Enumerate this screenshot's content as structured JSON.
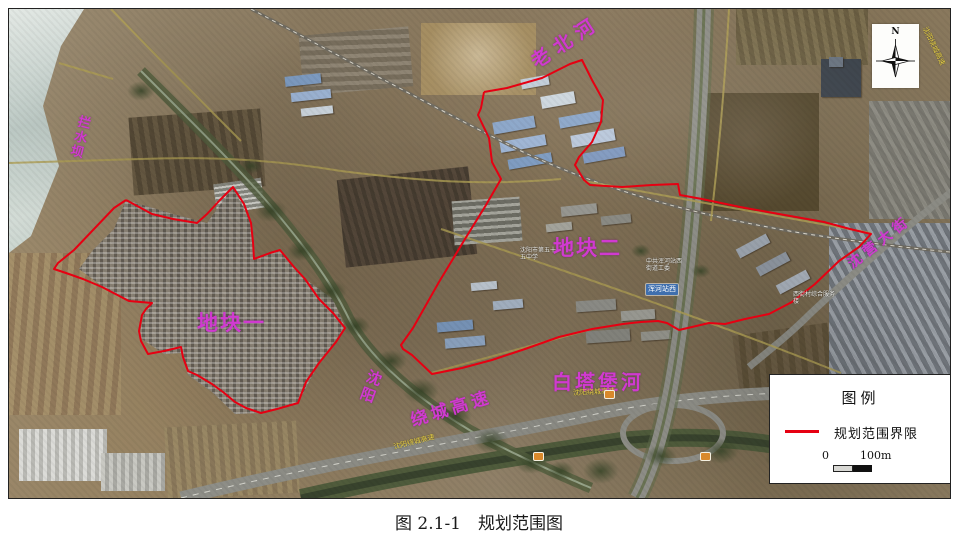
{
  "caption": "图 2.1-1　规划范围图",
  "map": {
    "plot_labels": {
      "plot1": "地块一",
      "plot2": "地块二"
    },
    "water_labels": {
      "dam": "拦水坝",
      "laobei_river": "老北河",
      "baitabao_river": "白塔堡河"
    },
    "road_labels": {
      "ring_expressway_part1": "沈阳",
      "ring_expressway_part2": "绕城高速",
      "shenying_street": "沈营大街"
    },
    "imagery_labels": {
      "ring_road_yellow_mid": "沈阳绕城高速",
      "ring_road_yellow_left": "沈阳绕城高速",
      "ring_road_yellow_top": "沈阳绕城高速",
      "hunhe_station_sign": "浑河站西",
      "school": "沈阳市第五十五中学",
      "committee": "中共浑河站西街道工委",
      "service_center": "西街村综合服务楼"
    },
    "boundary": {
      "color": "#e60012",
      "plot1_points": "125,199 151,213 172,218 196,222 206,213 219,199 232,186 243,203 250,222 252,241 253,258 269,252 279,249 293,266 304,278 318,298 332,312 344,327 335,341 318,362 305,381 297,402 276,408 260,412 245,407 234,401 222,391 211,383 196,374 187,370 182,356 180,346 163,350 147,353 140,340 138,330 141,314 145,308 151,302 128,300 101,286 82,278 65,272 53,268 57,262 73,249 93,228 113,207 125,199",
      "plot2_points": "483,91 506,87 541,77 569,63 581,59 591,79 602,99 600,121 591,141 578,156 574,164 583,179 589,184 621,186 651,184 677,183 679,194 701,198 739,206 778,213 823,221 849,228 870,233 858,246 838,260 814,283 791,301 768,313 744,318 724,323 708,322 691,326 678,329 666,322 657,320 640,321 622,323 591,328 558,336 524,348 491,359 461,367 431,373 411,354 402,348 400,344 412,327 438,281 464,238 485,204 500,178 491,161 488,137 477,114 480,107 483,91"
    }
  },
  "legend": {
    "title": "图例",
    "boundary_label": "规划范围界限",
    "scale_zero": "0",
    "scale_max": "100m"
  },
  "compass": {
    "north": "N"
  }
}
